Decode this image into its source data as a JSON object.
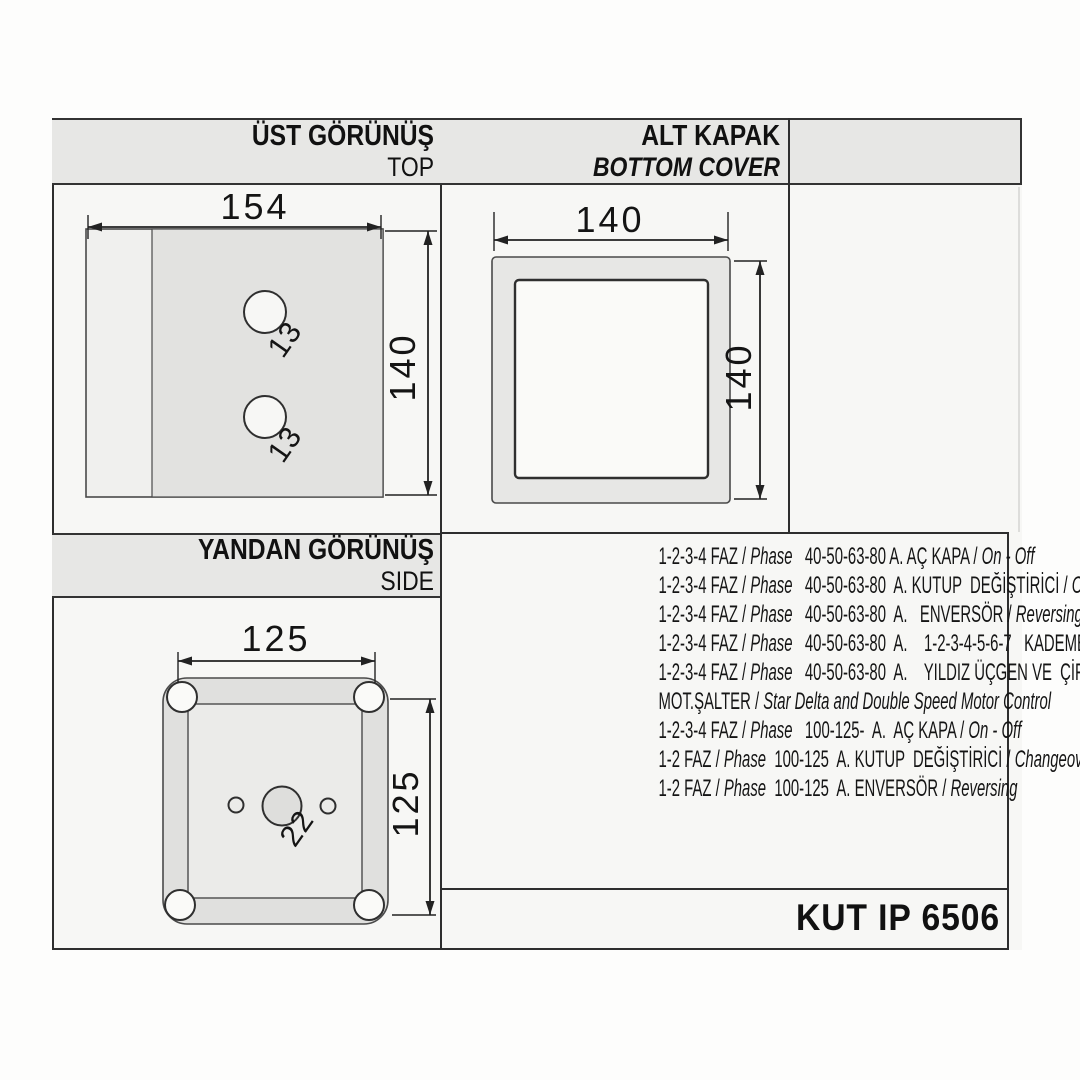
{
  "product_code": "KUT IP 6506",
  "sections": {
    "top_view": {
      "title_tr": "ÜST GÖRÜNÜŞ",
      "title_en": "TOP",
      "width_label": "154",
      "height_label": "140",
      "hole_labels": [
        "13",
        "13"
      ]
    },
    "bottom_cover": {
      "title_tr": "ALT KAPAK",
      "title_en": "BOTTOM COVER",
      "width_label": "140",
      "height_label": "140"
    },
    "side_view": {
      "title_tr": "YANDAN GÖRÜNÜŞ",
      "title_en": "SIDE",
      "width_label": "125",
      "height_label": "125",
      "hole_label": "22"
    }
  },
  "spec_lines": [
    {
      "segments": [
        {
          "text": "1-2-3-4 FAZ / ",
          "italic": false
        },
        {
          "text": "Phase",
          "italic": true
        },
        {
          "text": "   40-50-63-80 A. AÇ KAPA / ",
          "italic": false
        },
        {
          "text": "On - Off",
          "italic": true
        }
      ]
    },
    {
      "segments": [
        {
          "text": "1-2-3-4 FAZ / ",
          "italic": false
        },
        {
          "text": "Phase",
          "italic": true
        },
        {
          "text": "   40-50-63-80  A. KUTUP  DEĞİŞTİRİCİ / ",
          "italic": false
        },
        {
          "text": "Changeover",
          "italic": true
        }
      ]
    },
    {
      "segments": [
        {
          "text": "1-2-3-4 FAZ / ",
          "italic": false
        },
        {
          "text": "Phase",
          "italic": true
        },
        {
          "text": "   40-50-63-80  A.   ENVERSÖR / ",
          "italic": false
        },
        {
          "text": "Reversing",
          "italic": true
        }
      ]
    },
    {
      "segments": [
        {
          "text": "1-2-3-4 FAZ / ",
          "italic": false
        },
        {
          "text": "Phase",
          "italic": true
        },
        {
          "text": "   40-50-63-80  A.    1-2-3-4-5-6-7   KADEMELİ / ",
          "italic": false
        },
        {
          "text": "Steps",
          "italic": true
        }
      ]
    },
    {
      "segments": [
        {
          "text": "1-2-3-4 FAZ / ",
          "italic": false
        },
        {
          "text": "Phase",
          "italic": true
        },
        {
          "text": "   40-50-63-80  A.    YILDIZ ÜÇGEN VE  ÇİFT DEVİR",
          "italic": false
        }
      ]
    },
    {
      "segments": [
        {
          "text": "MOT.ŞALTER / ",
          "italic": false
        },
        {
          "text": "Star Delta and Double Speed Motor Control",
          "italic": true
        }
      ]
    },
    {
      "segments": [
        {
          "text": "1-2-3-4 FAZ / ",
          "italic": false
        },
        {
          "text": "Phase",
          "italic": true
        },
        {
          "text": "   100-125-  A.  AÇ KAPA / ",
          "italic": false
        },
        {
          "text": "On - Off",
          "italic": true
        }
      ]
    },
    {
      "segments": [
        {
          "text": "1-2 FAZ / ",
          "italic": false
        },
        {
          "text": "Phase",
          "italic": true
        },
        {
          "text": "  100-125  A. KUTUP  DEĞİŞTİRİCİ / ",
          "italic": false
        },
        {
          "text": "Changeover",
          "italic": true
        }
      ]
    },
    {
      "segments": [
        {
          "text": "1-2 FAZ / ",
          "italic": false
        },
        {
          "text": "Phase",
          "italic": true
        },
        {
          "text": "  100-125  A. ENVERSÖR / ",
          "italic": false
        },
        {
          "text": "Reversing",
          "italic": true
        }
      ]
    }
  ],
  "colors": {
    "header_bar": "#e7e7e5",
    "line": "#2e2e2e",
    "fill_gray": "#e2e2e0",
    "paper": "#f7f7f5"
  }
}
